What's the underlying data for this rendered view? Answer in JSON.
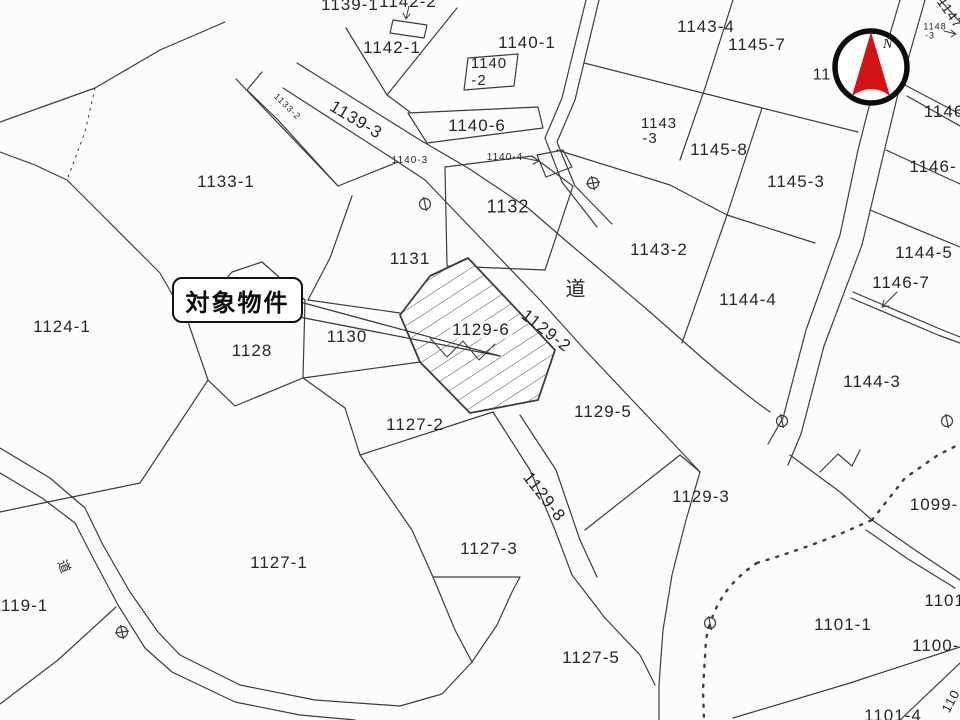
{
  "map": {
    "callout": {
      "text": "対象物件"
    },
    "compass": {
      "letter": "N",
      "needle_color": "#d31414",
      "ring_color": "#0d0d0d"
    },
    "colors": {
      "line": "#3c3c3c",
      "text": "#262626",
      "background": "#fcfcfb"
    },
    "parcels": [
      {
        "t": "1139-1",
        "x": 350,
        "y": 5,
        "r": 0,
        "fs": 17
      },
      {
        "t": "1142-2",
        "x": 408,
        "y": 2,
        "r": 0,
        "fs": 17
      },
      {
        "t": "1142-1",
        "x": 392,
        "y": 48,
        "r": 0,
        "fs": 17
      },
      {
        "t": "1140-1",
        "x": 527,
        "y": 43,
        "r": 0,
        "fs": 17
      },
      {
        "t": "1140",
        "x": 489,
        "y": 64,
        "r": 0,
        "fs": 15
      },
      {
        "t": "-2",
        "x": 479,
        "y": 81,
        "r": 0,
        "fs": 15
      },
      {
        "t": "1140-6",
        "x": 477,
        "y": 126,
        "r": 0,
        "fs": 17
      },
      {
        "t": "1139-3",
        "x": 356,
        "y": 120,
        "r": 31,
        "fs": 17
      },
      {
        "t": "1133-2",
        "x": 287,
        "y": 107,
        "r": 44,
        "fs": 9
      },
      {
        "t": "1140-3",
        "x": 410,
        "y": 161,
        "r": 0,
        "fs": 10
      },
      {
        "t": "1140-4",
        "x": 505,
        "y": 158,
        "r": 0,
        "fs": 10
      },
      {
        "t": "1133-1",
        "x": 226,
        "y": 182,
        "r": 0,
        "fs": 17
      },
      {
        "t": "1132",
        "x": 508,
        "y": 207,
        "r": 0,
        "fs": 18
      },
      {
        "t": "1131",
        "x": 410,
        "y": 259,
        "r": 0,
        "fs": 17
      },
      {
        "t": "道",
        "x": 576,
        "y": 290,
        "r": 0,
        "fs": 20
      },
      {
        "t": "1130",
        "x": 347,
        "y": 337,
        "r": 0,
        "fs": 17
      },
      {
        "t": "1128",
        "x": 252,
        "y": 351,
        "r": 0,
        "fs": 17
      },
      {
        "t": "1124-1",
        "x": 62,
        "y": 327,
        "r": 0,
        "fs": 17
      },
      {
        "t": "1129-6",
        "x": 481,
        "y": 330,
        "r": 0,
        "fs": 17,
        "halo": true
      },
      {
        "t": "1129-2",
        "x": 546,
        "y": 331,
        "r": 38,
        "fs": 17
      },
      {
        "t": "1127-2",
        "x": 415,
        "y": 425,
        "r": 0,
        "fs": 17
      },
      {
        "t": "1129-5",
        "x": 603,
        "y": 412,
        "r": 0,
        "fs": 17
      },
      {
        "t": "1129-8",
        "x": 544,
        "y": 497,
        "r": 52,
        "fs": 17
      },
      {
        "t": "1129-3",
        "x": 701,
        "y": 497,
        "r": 0,
        "fs": 17
      },
      {
        "t": "1127-3",
        "x": 489,
        "y": 549,
        "r": 0,
        "fs": 17
      },
      {
        "t": "1127-1",
        "x": 279,
        "y": 563,
        "r": 0,
        "fs": 17
      },
      {
        "t": "1119-1",
        "x": 20,
        "y": 606,
        "r": 0,
        "fs": 17
      },
      {
        "t": "道",
        "x": 64,
        "y": 567,
        "r": 68,
        "fs": 13
      },
      {
        "t": "1127-5",
        "x": 591,
        "y": 658,
        "r": 0,
        "fs": 17
      },
      {
        "t": "1101-1",
        "x": 843,
        "y": 625,
        "r": 0,
        "fs": 17
      },
      {
        "t": "1101-4",
        "x": 893,
        "y": 716,
        "r": 0,
        "fs": 17
      },
      {
        "t": "1100-2",
        "x": 941,
        "y": 646,
        "r": 0,
        "fs": 17
      },
      {
        "t": "1101-",
        "x": 948,
        "y": 601,
        "r": 0,
        "fs": 17
      },
      {
        "t": "1099-",
        "x": 934,
        "y": 505,
        "r": 0,
        "fs": 17
      },
      {
        "t": "110",
        "x": 951,
        "y": 701,
        "r": -62,
        "fs": 13
      },
      {
        "t": "1143-4",
        "x": 706,
        "y": 27,
        "r": 0,
        "fs": 17
      },
      {
        "t": "1145-7",
        "x": 757,
        "y": 45,
        "r": 0,
        "fs": 17
      },
      {
        "t": "1143",
        "x": 659,
        "y": 124,
        "r": 0,
        "fs": 15
      },
      {
        "t": "-3",
        "x": 650,
        "y": 139,
        "r": 0,
        "fs": 15
      },
      {
        "t": "1145-8",
        "x": 719,
        "y": 150,
        "r": 0,
        "fs": 17
      },
      {
        "t": "1145-3",
        "x": 796,
        "y": 182,
        "r": 0,
        "fs": 17
      },
      {
        "t": "1143-2",
        "x": 659,
        "y": 250,
        "r": 0,
        "fs": 17
      },
      {
        "t": "1144-4",
        "x": 748,
        "y": 300,
        "r": 0,
        "fs": 17
      },
      {
        "t": "1144-5",
        "x": 924,
        "y": 253,
        "r": 0,
        "fs": 17
      },
      {
        "t": "1146-7",
        "x": 901,
        "y": 283,
        "r": 0,
        "fs": 17
      },
      {
        "t": "1144-3",
        "x": 872,
        "y": 382,
        "r": 0,
        "fs": 17
      },
      {
        "t": "1146",
        "x": 944,
        "y": 112,
        "r": 0,
        "fs": 17
      },
      {
        "t": "1146-",
        "x": 933,
        "y": 167,
        "r": 0,
        "fs": 17
      },
      {
        "t": "1148",
        "x": 935,
        "y": 27,
        "r": 0,
        "fs": 9
      },
      {
        "t": "-3",
        "x": 930,
        "y": 36,
        "r": 0,
        "fs": 9
      },
      {
        "t": "1147",
        "x": 950,
        "y": 13,
        "r": 55,
        "fs": 14
      },
      {
        "t": "11",
        "x": 822,
        "y": 76,
        "r": 0,
        "fs": 16
      }
    ],
    "symbols": [
      {
        "type": "pole-icon",
        "x": 425,
        "y": 204
      },
      {
        "type": "pole-icon",
        "x": 782,
        "y": 421
      },
      {
        "type": "pole-icon",
        "x": 947,
        "y": 421
      },
      {
        "type": "pole-icon",
        "x": 710,
        "y": 623
      },
      {
        "type": "benchmark-icon",
        "x": 593,
        "y": 183
      },
      {
        "type": "benchmark-icon",
        "x": 122,
        "y": 632
      }
    ]
  }
}
